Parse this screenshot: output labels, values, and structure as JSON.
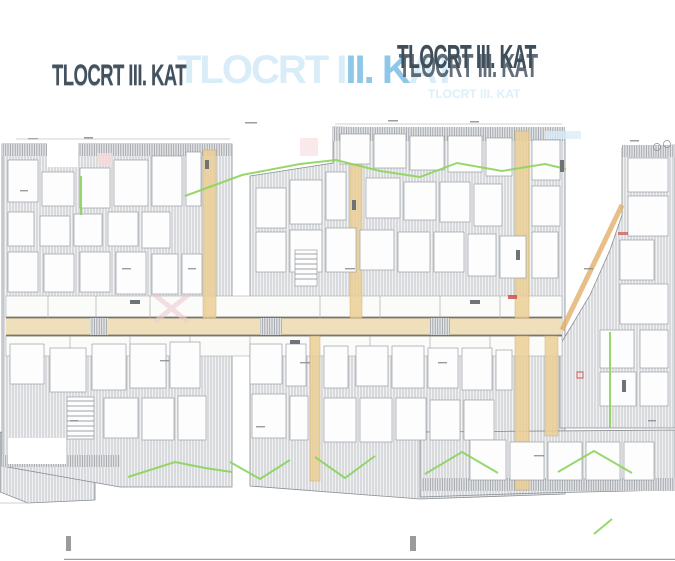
{
  "title": {
    "left": "TLOCRT III. KAT",
    "right": "TLOCRT III. KAT",
    "faint": "TLOCRT III. KAT",
    "blue": {
      "pre": "TLOCRT I",
      "mid": "II. K",
      "post": "AT"
    }
  },
  "palette": {
    "title_dark": "#3f4e5b",
    "title_blue_light": "#d8edf8",
    "title_blue_mid": "#8fc7e9",
    "hatch_line": "#b3b8bd",
    "hatch_bg": "#f0f1f2",
    "wall_gray": "#8a8f94",
    "corridor_fill": "#efe0bb",
    "shaft_tan": "#eccf96",
    "accent_orange": "#dfa95f",
    "accent_green": "#8cd45c",
    "accent_red": "#c9524e",
    "accent_pink": "#edc9cf",
    "baseline_gray": "#8f9398"
  }
}
